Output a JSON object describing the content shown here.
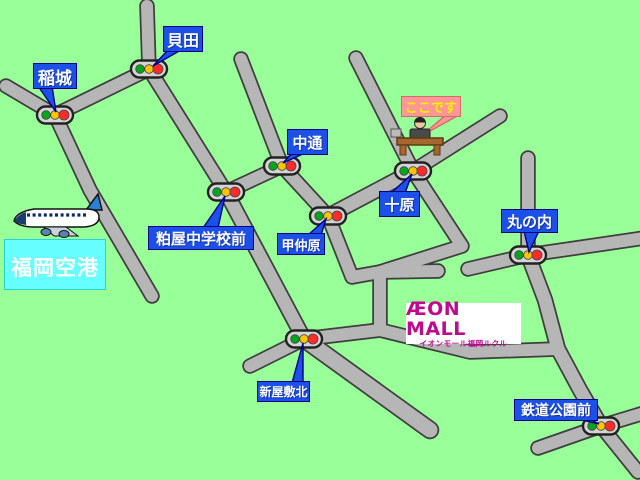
{
  "map": {
    "colors": {
      "background": "#99ff99",
      "road_fill": "#b6b6b6",
      "road_outline": "#3f3f3f",
      "label_blue": "#1c50e8",
      "label_border": "#000080",
      "label_text": "#ffffff",
      "here_bg": "#ff9797",
      "here_text": "#ffef00",
      "airport_bg": "#66ffff",
      "airport_text": "#ffffff",
      "aeon_magenta": "#bf0a8c",
      "signal_body": "#d4d4d4",
      "signal_green": "#00a61b",
      "signal_yellow": "#ffc400",
      "signal_red": "#ff2b2b"
    },
    "roads": [
      {
        "points": [
          [
            6,
            86
          ],
          [
            55,
            115
          ]
        ]
      },
      {
        "points": [
          [
            55,
            115
          ],
          [
            149,
            69
          ]
        ]
      },
      {
        "points": [
          [
            149,
            69
          ],
          [
            147,
            6
          ]
        ]
      },
      {
        "points": [
          [
            55,
            115
          ],
          [
            90,
            190
          ],
          [
            152,
            296
          ]
        ]
      },
      {
        "points": [
          [
            149,
            69
          ],
          [
            226,
            192
          ]
        ]
      },
      {
        "points": [
          [
            226,
            192
          ],
          [
            304,
            339
          ]
        ],
        "w": 13
      },
      {
        "points": [
          [
            226,
            192
          ],
          [
            282,
            166
          ]
        ]
      },
      {
        "points": [
          [
            282,
            166
          ],
          [
            241,
            59
          ]
        ]
      },
      {
        "points": [
          [
            282,
            166
          ],
          [
            328,
            216
          ]
        ]
      },
      {
        "points": [
          [
            328,
            216
          ],
          [
            413,
            171
          ]
        ],
        "w": 13
      },
      {
        "points": [
          [
            413,
            171
          ],
          [
            356,
            58
          ]
        ]
      },
      {
        "points": [
          [
            413,
            171
          ],
          [
            500,
            116
          ]
        ]
      },
      {
        "points": [
          [
            413,
            171
          ],
          [
            462,
            246
          ],
          [
            380,
            272
          ]
        ]
      },
      {
        "points": [
          [
            328,
            216
          ],
          [
            352,
            277
          ],
          [
            380,
            272
          ],
          [
            438,
            271
          ]
        ]
      },
      {
        "points": [
          [
            380,
            272
          ],
          [
            380,
            330
          ]
        ]
      },
      {
        "points": [
          [
            304,
            339
          ],
          [
            380,
            330
          ]
        ]
      },
      {
        "points": [
          [
            380,
            330
          ],
          [
            470,
            352
          ],
          [
            558,
            349
          ]
        ]
      },
      {
        "points": [
          [
            528,
            255
          ],
          [
            545,
            300
          ],
          [
            558,
            349
          ],
          [
            580,
            390
          ],
          [
            601,
            426
          ]
        ],
        "w": 13
      },
      {
        "points": [
          [
            528,
            255
          ],
          [
            528,
            158
          ]
        ]
      },
      {
        "points": [
          [
            528,
            255
          ],
          [
            644,
            238
          ]
        ]
      },
      {
        "points": [
          [
            528,
            255
          ],
          [
            468,
            269
          ]
        ]
      },
      {
        "points": [
          [
            304,
            339
          ],
          [
            250,
            366
          ]
        ]
      },
      {
        "points": [
          [
            304,
            339
          ],
          [
            430,
            430
          ]
        ],
        "w": 15
      },
      {
        "points": [
          [
            601,
            426
          ],
          [
            538,
            448
          ]
        ]
      },
      {
        "points": [
          [
            601,
            426
          ],
          [
            644,
            413
          ]
        ]
      },
      {
        "points": [
          [
            601,
            426
          ],
          [
            638,
            472
          ]
        ]
      }
    ],
    "signals": [
      [
        55,
        115
      ],
      [
        149,
        69
      ],
      [
        226,
        192
      ],
      [
        282,
        166
      ],
      [
        328,
        216
      ],
      [
        413,
        171
      ],
      [
        528,
        255
      ],
      [
        304,
        339
      ],
      [
        601,
        426
      ]
    ],
    "labels": [
      {
        "id": "inagi",
        "text": "稲城",
        "x": 33,
        "y": 63,
        "w": 44,
        "h": 26,
        "fs": 17,
        "tail": [
          [
            38,
            86
          ],
          [
            52,
            86
          ],
          [
            56,
            112
          ]
        ]
      },
      {
        "id": "kaida",
        "text": "貝田",
        "x": 163,
        "y": 26,
        "w": 40,
        "h": 26,
        "fs": 16,
        "tail": [
          [
            168,
            50
          ],
          [
            181,
            50
          ],
          [
            153,
            66
          ]
        ]
      },
      {
        "id": "nakadori",
        "text": "中通",
        "x": 287,
        "y": 129,
        "w": 41,
        "h": 26,
        "fs": 15,
        "tail": [
          [
            292,
            153
          ],
          [
            305,
            153
          ],
          [
            283,
            163
          ]
        ]
      },
      {
        "id": "juhara",
        "text": "十原",
        "x": 379,
        "y": 191,
        "w": 41,
        "h": 26,
        "fs": 15,
        "tail": [
          [
            391,
            193
          ],
          [
            405,
            193
          ],
          [
            412,
            174
          ]
        ]
      },
      {
        "id": "marunouchi",
        "text": "丸の内",
        "x": 501,
        "y": 209,
        "w": 57,
        "h": 24,
        "fs": 15,
        "tail": [
          [
            524,
            231
          ],
          [
            539,
            231
          ],
          [
            529,
            252
          ]
        ]
      },
      {
        "id": "kasuya-chugakko-mae",
        "text": "粕屋中学校前",
        "x": 148,
        "y": 226,
        "w": 106,
        "h": 24,
        "fs": 15,
        "tail": [
          [
            203,
            228
          ],
          [
            218,
            228
          ],
          [
            225,
            196
          ]
        ]
      },
      {
        "id": "konakabaru",
        "text": "甲仲原",
        "x": 277,
        "y": 233,
        "w": 48,
        "h": 22,
        "fs": 13,
        "tail": [
          [
            308,
            235
          ],
          [
            321,
            235
          ],
          [
            326,
            219
          ]
        ]
      },
      {
        "id": "shinyashiki-kita",
        "text": "新屋敷北",
        "x": 257,
        "y": 381,
        "w": 53,
        "h": 21,
        "fs": 12,
        "tail": [
          [
            292,
            383
          ],
          [
            303,
            383
          ],
          [
            303,
            343
          ]
        ]
      },
      {
        "id": "tetsudo-koen-mae",
        "text": "鉄道公園前",
        "x": 514,
        "y": 399,
        "w": 84,
        "h": 22,
        "fs": 14,
        "tail": [
          [
            577,
            419
          ],
          [
            590,
            419
          ],
          [
            599,
            424
          ]
        ]
      }
    ],
    "here": {
      "text": "ここです",
      "tail": [
        [
          446,
          115
        ],
        [
          459,
          115
        ],
        [
          421,
          136
        ]
      ]
    },
    "airport": {
      "text": "福岡空港"
    },
    "aeon": {
      "line1": "ÆON MALL",
      "line2": "イオンモール福岡ルクル"
    }
  }
}
